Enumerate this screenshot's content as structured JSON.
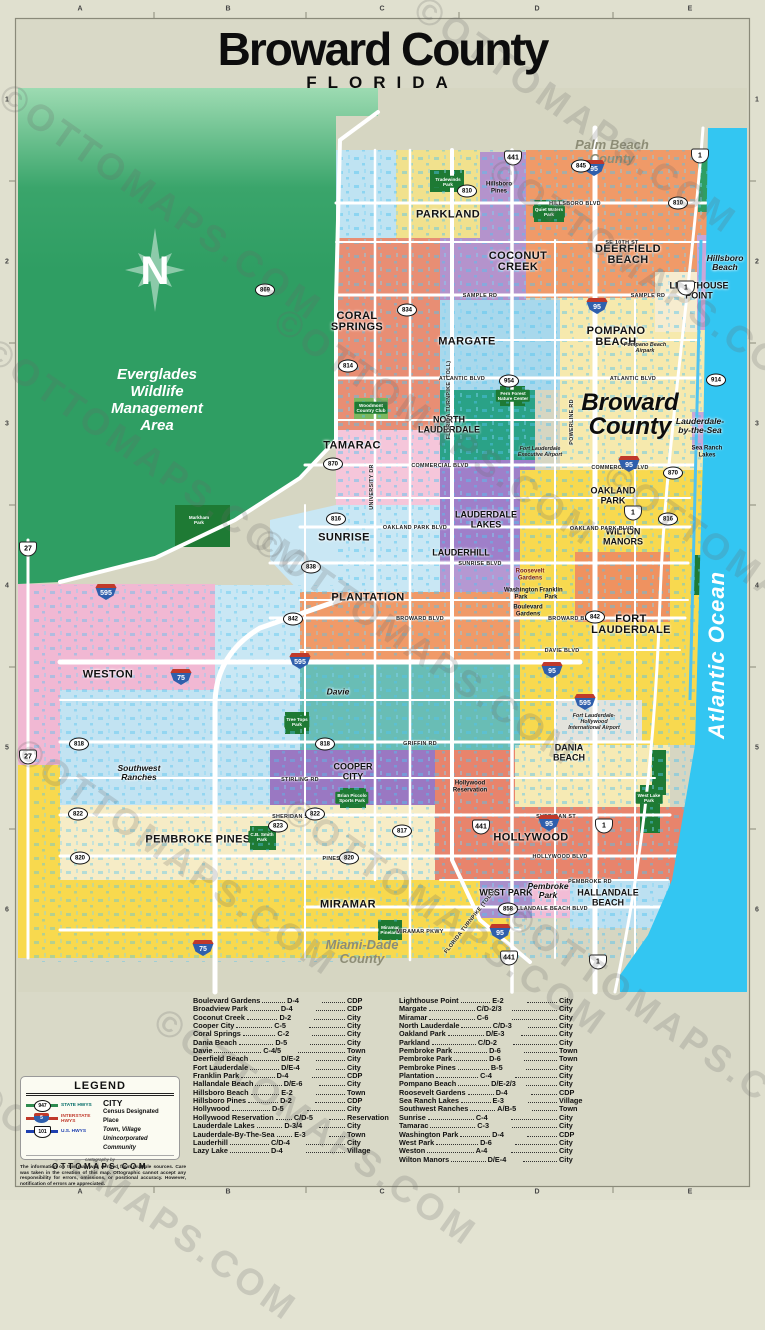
{
  "page": {
    "title": "Broward County",
    "subtitle": "FLORIDA",
    "watermark": "©OTTOMAPS.COM"
  },
  "rulers": {
    "letters": [
      "A",
      "B",
      "C",
      "D",
      "E"
    ],
    "numbers": [
      "1",
      "2",
      "3",
      "4",
      "5",
      "6"
    ]
  },
  "map": {
    "labels": [
      {
        "t": "Palm Beach\nCounty",
        "x": 612,
        "y": 152,
        "c": "county"
      },
      {
        "t": "Miami-Dade\nCounty",
        "x": 362,
        "y": 952,
        "c": "county"
      },
      {
        "t": "Everglades\nWildlife\nManagement\nArea",
        "x": 157,
        "y": 400,
        "c": "evg"
      },
      {
        "t": "Broward\nCounty",
        "x": 630,
        "y": 415,
        "c": "bigcounty"
      },
      {
        "t": "Atlantic Ocean",
        "x": 717,
        "y": 655,
        "c": "oceanlbl",
        "r": -90
      },
      {
        "t": "PARKLAND",
        "x": 448,
        "y": 215,
        "c": "city"
      },
      {
        "t": "COCONUT\nCREEK",
        "x": 518,
        "y": 262,
        "c": "city"
      },
      {
        "t": "DEERFIELD\nBEACH",
        "x": 628,
        "y": 255,
        "c": "city"
      },
      {
        "t": "LIGHTHOUSE\nPOINT",
        "x": 699,
        "y": 291,
        "c": "citysm"
      },
      {
        "t": "CORAL\nSPRINGS",
        "x": 357,
        "y": 322,
        "c": "city"
      },
      {
        "t": "MARGATE",
        "x": 467,
        "y": 342,
        "c": "city"
      },
      {
        "t": "POMPANO\nBEACH",
        "x": 616,
        "y": 337,
        "c": "city"
      },
      {
        "t": "NORTH\nLAUDERDALE",
        "x": 449,
        "y": 425,
        "c": "citysm"
      },
      {
        "t": "TAMARAC",
        "x": 352,
        "y": 446,
        "c": "city"
      },
      {
        "t": "SUNRISE",
        "x": 344,
        "y": 538,
        "c": "city"
      },
      {
        "t": "LAUDERDALE\nLAKES",
        "x": 486,
        "y": 520,
        "c": "citysm"
      },
      {
        "t": "LAUDERHILL",
        "x": 461,
        "y": 553,
        "c": "citysm"
      },
      {
        "t": "WILTON\nMANORS",
        "x": 623,
        "y": 537,
        "c": "citysm"
      },
      {
        "t": "OAKLAND\nPARK",
        "x": 613,
        "y": 496,
        "c": "citysm"
      },
      {
        "t": "PLANTATION",
        "x": 368,
        "y": 598,
        "c": "city"
      },
      {
        "t": "FORT\nLAUDERDALE",
        "x": 631,
        "y": 625,
        "c": "city"
      },
      {
        "t": "WESTON",
        "x": 108,
        "y": 675,
        "c": "city"
      },
      {
        "t": "COOPER\nCITY",
        "x": 353,
        "y": 772,
        "c": "citysm"
      },
      {
        "t": "PEMBROKE PINES",
        "x": 198,
        "y": 840,
        "c": "city"
      },
      {
        "t": "HOLLYWOOD",
        "x": 531,
        "y": 838,
        "c": "city"
      },
      {
        "t": "MIRAMAR",
        "x": 348,
        "y": 905,
        "c": "city"
      },
      {
        "t": "WEST PARK",
        "x": 506,
        "y": 893,
        "c": "citysm"
      },
      {
        "t": "HALLANDALE\nBEACH",
        "x": 608,
        "y": 898,
        "c": "citysm"
      },
      {
        "t": "DANIA\nBEACH",
        "x": 569,
        "y": 753,
        "c": "citysm"
      },
      {
        "t": "Hillsboro\nPines",
        "x": 499,
        "y": 188,
        "c": "cdp"
      },
      {
        "t": "Hillsboro\nBeach",
        "x": 725,
        "y": 263,
        "c": "town"
      },
      {
        "t": "Lauderdale-\nby-the-Sea",
        "x": 700,
        "y": 426,
        "c": "town"
      },
      {
        "t": "Sea Ranch\nLakes",
        "x": 707,
        "y": 452,
        "c": "cdp"
      },
      {
        "t": "Davie",
        "x": 338,
        "y": 692,
        "c": "town"
      },
      {
        "t": "Southwest\nRanches",
        "x": 139,
        "y": 773,
        "c": "town"
      },
      {
        "t": "Hollywood\nReservation",
        "x": 470,
        "y": 787,
        "c": "cdp"
      },
      {
        "t": "Pembroke\nPark",
        "x": 548,
        "y": 891,
        "c": "town"
      },
      {
        "t": "Roosevelt\nGardens",
        "x": 530,
        "y": 575,
        "c": "cdp red"
      },
      {
        "t": "Washington\nPark",
        "x": 521,
        "y": 594,
        "c": "cdp"
      },
      {
        "t": "Franklin\nPark",
        "x": 551,
        "y": 594,
        "c": "cdp"
      },
      {
        "t": "Boulevard\nGardens",
        "x": 528,
        "y": 611,
        "c": "cdp"
      },
      {
        "t": "Tradewinds\nPark",
        "x": 448,
        "y": 182,
        "c": "park"
      },
      {
        "t": "Quiet Waters\nPark",
        "x": 549,
        "y": 212,
        "c": "park"
      },
      {
        "t": "Fern Forest\nNature Center",
        "x": 513,
        "y": 396,
        "c": "park"
      },
      {
        "t": "Woodmont\nCountry Club",
        "x": 371,
        "y": 408,
        "c": "park"
      },
      {
        "t": "Markham\nPark",
        "x": 199,
        "y": 520,
        "c": "park"
      },
      {
        "t": "Tree Tops\nPark",
        "x": 297,
        "y": 722,
        "c": "park"
      },
      {
        "t": "C.B. Smith\nPark",
        "x": 262,
        "y": 837,
        "c": "park"
      },
      {
        "t": "Brian Piccolo\nSports Park",
        "x": 352,
        "y": 798,
        "c": "park"
      },
      {
        "t": "Miramar\nPineland",
        "x": 390,
        "y": 930,
        "c": "park"
      },
      {
        "t": "West Lake\nPark",
        "x": 649,
        "y": 798,
        "c": "park"
      },
      {
        "t": "Pompano Beach\nAirpark",
        "x": 645,
        "y": 348,
        "c": "fac"
      },
      {
        "t": "Fort Lauderdale\nExecutive Airport",
        "x": 540,
        "y": 452,
        "c": "fac"
      },
      {
        "t": "Fort Lauderdale-\nHollywood\nInternational Airport",
        "x": 594,
        "y": 722,
        "c": "fac"
      },
      {
        "t": "HILLSBORO BLVD",
        "x": 575,
        "y": 204,
        "c": "road"
      },
      {
        "t": "SE 10TH ST",
        "x": 622,
        "y": 243,
        "c": "road"
      },
      {
        "t": "SAMPLE RD",
        "x": 480,
        "y": 296,
        "c": "road"
      },
      {
        "t": "SAMPLE RD",
        "x": 648,
        "y": 296,
        "c": "road"
      },
      {
        "t": "ATLANTIC BLVD",
        "x": 462,
        "y": 379,
        "c": "road"
      },
      {
        "t": "ATLANTIC BLVD",
        "x": 633,
        "y": 379,
        "c": "road"
      },
      {
        "t": "COMMERCIAL BLVD",
        "x": 440,
        "y": 466,
        "c": "road"
      },
      {
        "t": "COMMERCIAL BLVD",
        "x": 620,
        "y": 468,
        "c": "road"
      },
      {
        "t": "OAKLAND PARK BLVD",
        "x": 415,
        "y": 528,
        "c": "road"
      },
      {
        "t": "OAKLAND PARK BLVD",
        "x": 602,
        "y": 529,
        "c": "road"
      },
      {
        "t": "SUNRISE BLVD",
        "x": 480,
        "y": 564,
        "c": "road"
      },
      {
        "t": "BROWARD BLVD",
        "x": 420,
        "y": 619,
        "c": "road"
      },
      {
        "t": "BROWARD BLVD",
        "x": 572,
        "y": 619,
        "c": "road"
      },
      {
        "t": "DAVIE BLVD",
        "x": 562,
        "y": 651,
        "c": "road"
      },
      {
        "t": "GRIFFIN RD",
        "x": 420,
        "y": 744,
        "c": "road"
      },
      {
        "t": "STIRLING RD",
        "x": 300,
        "y": 780,
        "c": "road"
      },
      {
        "t": "SHERIDAN ST",
        "x": 292,
        "y": 817,
        "c": "road"
      },
      {
        "t": "SHERIDAN ST",
        "x": 556,
        "y": 817,
        "c": "road"
      },
      {
        "t": "PINES BLVD",
        "x": 340,
        "y": 859,
        "c": "road"
      },
      {
        "t": "HOLLYWOOD BLVD",
        "x": 560,
        "y": 857,
        "c": "road"
      },
      {
        "t": "PEMBROKE RD",
        "x": 590,
        "y": 882,
        "c": "road"
      },
      {
        "t": "HALLANDALE BEACH BLVD",
        "x": 548,
        "y": 909,
        "c": "road"
      },
      {
        "t": "MIRAMAR PKWY",
        "x": 420,
        "y": 932,
        "c": "road"
      },
      {
        "t": "FLORIDA TURNPIKE (TOLL)",
        "x": 449,
        "y": 400,
        "c": "road",
        "r": -90
      },
      {
        "t": "FLORIDA TURNPIKE (TOLL)",
        "x": 470,
        "y": 922,
        "c": "road",
        "r": -52
      },
      {
        "t": "UNIVERSITY DR",
        "x": 372,
        "y": 487,
        "c": "road",
        "r": -90
      },
      {
        "t": "POWERLINE RD",
        "x": 572,
        "y": 422,
        "c": "road",
        "r": -90
      }
    ],
    "shields": [
      {
        "k": "i",
        "n": "95",
        "x": 594,
        "y": 168
      },
      {
        "k": "i",
        "n": "95",
        "x": 597,
        "y": 306
      },
      {
        "k": "i",
        "n": "95",
        "x": 629,
        "y": 464
      },
      {
        "k": "i",
        "n": "95",
        "x": 552,
        "y": 670
      },
      {
        "k": "i",
        "n": "95",
        "x": 549,
        "y": 823
      },
      {
        "k": "i",
        "n": "95",
        "x": 500,
        "y": 932
      },
      {
        "k": "i",
        "n": "75",
        "x": 181,
        "y": 677
      },
      {
        "k": "i",
        "n": "75",
        "x": 203,
        "y": 948
      },
      {
        "k": "i",
        "n": "595",
        "x": 106,
        "y": 592
      },
      {
        "k": "i",
        "n": "595",
        "x": 300,
        "y": 661
      },
      {
        "k": "i",
        "n": "595",
        "x": 585,
        "y": 702
      },
      {
        "k": "u",
        "n": "1",
        "x": 700,
        "y": 156
      },
      {
        "k": "u",
        "n": "1",
        "x": 686,
        "y": 288
      },
      {
        "k": "u",
        "n": "1",
        "x": 633,
        "y": 513
      },
      {
        "k": "u",
        "n": "1",
        "x": 604,
        "y": 826
      },
      {
        "k": "u",
        "n": "1",
        "x": 598,
        "y": 962
      },
      {
        "k": "u",
        "n": "441",
        "x": 513,
        "y": 158
      },
      {
        "k": "u",
        "n": "441",
        "x": 481,
        "y": 827
      },
      {
        "k": "u",
        "n": "441",
        "x": 509,
        "y": 958
      },
      {
        "k": "u",
        "n": "27",
        "x": 28,
        "y": 549
      },
      {
        "k": "u",
        "n": "27",
        "x": 28,
        "y": 757
      },
      {
        "k": "s",
        "n": "845",
        "x": 581,
        "y": 166
      },
      {
        "k": "s",
        "n": "810",
        "x": 467,
        "y": 191
      },
      {
        "k": "s",
        "n": "810",
        "x": 678,
        "y": 203
      },
      {
        "k": "s",
        "n": "869",
        "x": 265,
        "y": 290
      },
      {
        "k": "s",
        "n": "834",
        "x": 407,
        "y": 310
      },
      {
        "k": "s",
        "n": "814",
        "x": 348,
        "y": 366
      },
      {
        "k": "s",
        "n": "954",
        "x": 509,
        "y": 381
      },
      {
        "k": "s",
        "n": "914",
        "x": 716,
        "y": 380
      },
      {
        "k": "s",
        "n": "870",
        "x": 333,
        "y": 464
      },
      {
        "k": "s",
        "n": "870",
        "x": 673,
        "y": 473
      },
      {
        "k": "s",
        "n": "816",
        "x": 336,
        "y": 519
      },
      {
        "k": "s",
        "n": "816",
        "x": 668,
        "y": 519
      },
      {
        "k": "s",
        "n": "838",
        "x": 311,
        "y": 567
      },
      {
        "k": "s",
        "n": "842",
        "x": 293,
        "y": 619
      },
      {
        "k": "s",
        "n": "842",
        "x": 595,
        "y": 617
      },
      {
        "k": "s",
        "n": "818",
        "x": 79,
        "y": 744
      },
      {
        "k": "s",
        "n": "818",
        "x": 325,
        "y": 744
      },
      {
        "k": "s",
        "n": "822",
        "x": 78,
        "y": 814
      },
      {
        "k": "s",
        "n": "822",
        "x": 315,
        "y": 814
      },
      {
        "k": "s",
        "n": "823",
        "x": 278,
        "y": 826
      },
      {
        "k": "s",
        "n": "817",
        "x": 402,
        "y": 831
      },
      {
        "k": "s",
        "n": "820",
        "x": 80,
        "y": 858
      },
      {
        "k": "s",
        "n": "820",
        "x": 349,
        "y": 858
      },
      {
        "k": "s",
        "n": "858",
        "x": 508,
        "y": 909
      }
    ]
  },
  "index": {
    "left": [
      {
        "name": "Boulevard Gardens",
        "grid": "D-4",
        "type": "CDP"
      },
      {
        "name": "Broadview Park",
        "grid": "D-4",
        "type": "CDP"
      },
      {
        "name": "Coconut Creek",
        "grid": "D-2",
        "type": "City"
      },
      {
        "name": "Cooper City",
        "grid": "C-5",
        "type": "City"
      },
      {
        "name": "Coral Springs",
        "grid": "C-2",
        "type": "City"
      },
      {
        "name": "Dania Beach",
        "grid": "D-5",
        "type": "City"
      },
      {
        "name": "Davie",
        "grid": "C-4/5",
        "type": "Town"
      },
      {
        "name": "Deerfield Beach",
        "grid": "D/E-2",
        "type": "City"
      },
      {
        "name": "Fort Lauderdale",
        "grid": "D/E-4",
        "type": "City"
      },
      {
        "name": "Franklin Park",
        "grid": "D-4",
        "type": "CDP"
      },
      {
        "name": "Hallandale Beach",
        "grid": "D/E-6",
        "type": "City"
      },
      {
        "name": "Hillsboro Beach",
        "grid": "E-2",
        "type": "Town"
      },
      {
        "name": "Hillsboro Pines",
        "grid": "D-2",
        "type": "CDP"
      },
      {
        "name": "Hollywood",
        "grid": "D-5",
        "type": "City"
      },
      {
        "name": "Hollywood Reservation",
        "grid": "C/D-5",
        "type": "Reservation"
      },
      {
        "name": "Lauderdale Lakes",
        "grid": "D-3/4",
        "type": "City"
      },
      {
        "name": "Lauderdale-By-The-Sea",
        "grid": "E-3",
        "type": "Town"
      },
      {
        "name": "Lauderhill",
        "grid": "C/D-4",
        "type": "City"
      },
      {
        "name": "Lazy Lake",
        "grid": "D-4",
        "type": "Village"
      }
    ],
    "right": [
      {
        "name": "Lighthouse Point",
        "grid": "E-2",
        "type": "City"
      },
      {
        "name": "Margate",
        "grid": "C/D-2/3",
        "type": "City"
      },
      {
        "name": "Miramar",
        "grid": "C-6",
        "type": "City"
      },
      {
        "name": "North Lauderdale",
        "grid": "C/D-3",
        "type": "City"
      },
      {
        "name": "Oakland Park",
        "grid": "D/E-3",
        "type": "City"
      },
      {
        "name": "Parkland",
        "grid": "C/D-2",
        "type": "City"
      },
      {
        "name": "Pembroke Park",
        "grid": "D-6",
        "type": "Town"
      },
      {
        "name": "Pembroke Park",
        "grid": "D-6",
        "type": "Town"
      },
      {
        "name": "Pembroke Pines",
        "grid": "B-5",
        "type": "City"
      },
      {
        "name": "Plantation",
        "grid": "C-4",
        "type": "City"
      },
      {
        "name": "Pompano Beach",
        "grid": "D/E-2/3",
        "type": "City"
      },
      {
        "name": "Roosevelt Gardens",
        "grid": "D-4",
        "type": "CDP"
      },
      {
        "name": "Sea Ranch Lakes",
        "grid": "E-3",
        "type": "Village"
      },
      {
        "name": "Southwest Ranches",
        "grid": "A/B-5",
        "type": "Town"
      },
      {
        "name": "Sunrise",
        "grid": "C-4",
        "type": "City"
      },
      {
        "name": "Tamarac",
        "grid": "C-3",
        "type": "City"
      },
      {
        "name": "Washington Park",
        "grid": "D-4",
        "type": "CDP"
      },
      {
        "name": "West Park",
        "grid": "D-6",
        "type": "City"
      },
      {
        "name": "Weston",
        "grid": "A-4",
        "type": "City"
      },
      {
        "name": "Wilton Manors",
        "grid": "D/E-4",
        "type": "City"
      }
    ]
  },
  "legend": {
    "title": "LEGEND",
    "road_types": [
      {
        "label": "STATE HWYS",
        "shield": "947",
        "type": "state"
      },
      {
        "label": "INTERSTATE HWYS",
        "shield": "5",
        "type": "interstate"
      },
      {
        "label": "U.S. HWYS",
        "shield": "101",
        "type": "us"
      }
    ],
    "place_types": [
      {
        "text": "CITY",
        "cls": "city"
      },
      {
        "text": "Census Designated Place",
        "cls": "cdp"
      },
      {
        "text": "Town, Village",
        "cls": "town"
      },
      {
        "text": "Unincorporated Community",
        "cls": "uninc"
      }
    ],
    "credit_label": "cartography by",
    "credit_name": "OTTOMAPS.COM"
  },
  "disclaimer": "The information on this map was derived from multiple sources. Care was taken in the creation of this map. Ottographic cannot accept any responsibility for errors, omissions, or positional accuracy. However, notification of errors are appreciated.",
  "colors": {
    "page_bg": "#d9d9c7",
    "ocean": "#33c6f2",
    "everglades": "#2f9e63",
    "state_hwy": "#2e8b4f",
    "interstate_hwy": "#c0392b",
    "us_hwy": "#1d3fb0",
    "park_green": "#1e7a34",
    "water_speckle": "#4fc3f0"
  }
}
